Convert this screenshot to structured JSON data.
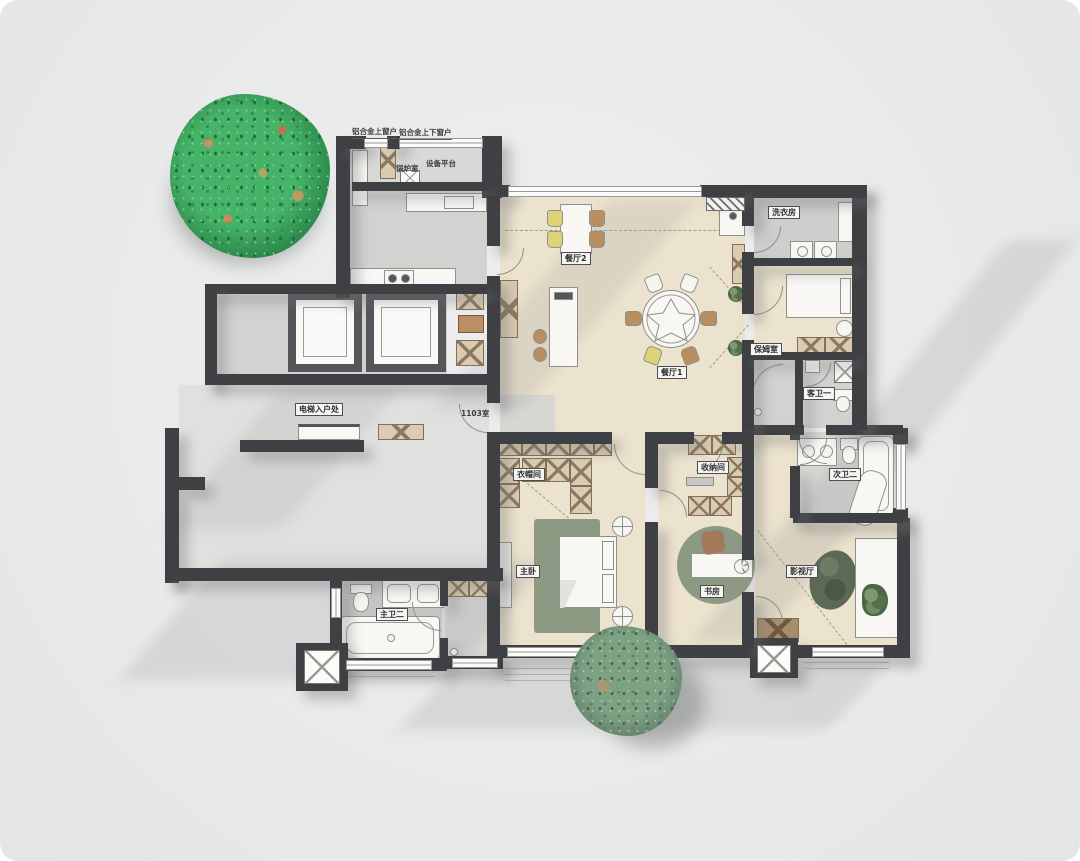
{
  "plan_title": "residential-floor-plan",
  "window_notes": {
    "note1": "铝合金上窗户",
    "note2": "铝合金上下窗户"
  },
  "rooms": {
    "boiler": "锅炉室",
    "equipment": "设备平台",
    "dining1": "餐厅1",
    "dining2": "餐厅2",
    "laundry": "洗衣房",
    "nanny": "保姆室",
    "guest_bath": "客卫一",
    "second_bath": "次卫二",
    "theater": "影视厅",
    "storage": "收纳间",
    "study": "书房",
    "master_bedroom": "主卧",
    "closet": "衣帽间",
    "master_bath": "主卫二",
    "elevator_entry": "电梯入户处",
    "unit_number": "1103室"
  },
  "palette": {
    "wall": "#3e4043",
    "floor_beige": "#ece3ce",
    "floor_gray": "#d3d2d0",
    "lobby_gray": "#e1e0de",
    "cabinet_wood": "#dccab1",
    "rug_green": "#8c9a84",
    "theater_oval_green": "#5c6954",
    "chair_yellow": "#ded279",
    "chair_brown": "#b98e61",
    "tree_bright_green": "#46b468",
    "tree_sage_green": "#7da183",
    "background": "#e9eaea"
  }
}
